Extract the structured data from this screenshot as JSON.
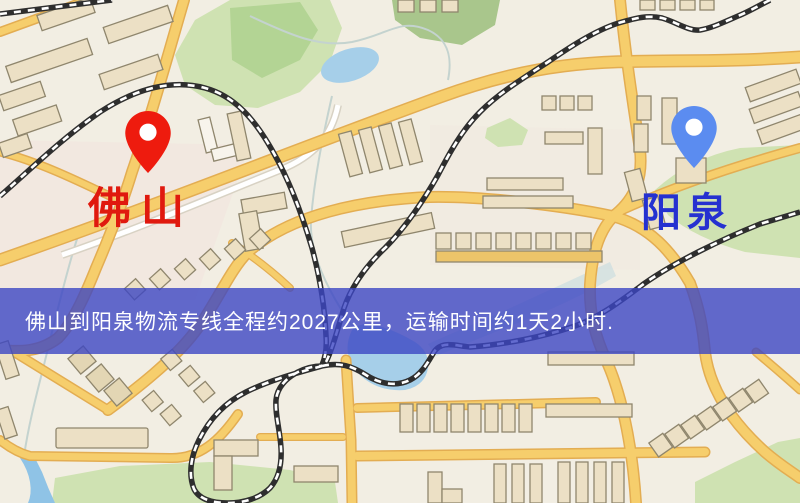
{
  "banner": {
    "text": "佛山到阳泉物流专线全程约2027公里，运输时间约1天2小时.",
    "background_color": "rgba(60,70,195,0.8)",
    "text_color": "#ffffff"
  },
  "route": {
    "origin": "佛山",
    "destination": "阳泉",
    "distance_text": "约2027公里",
    "duration_text": "约1天2小时"
  },
  "markers": {
    "origin": {
      "name": "佛山",
      "pin_color": "#ee1b0e",
      "label_color": "#e0190e"
    },
    "destination": {
      "name": "阳泉",
      "pin_color": "#5b8cf0",
      "label_color": "#2531d0"
    }
  },
  "map": {
    "colors": {
      "background": "#f2eee3",
      "road_fill": "#f6ce6c",
      "road_casing": "#e3ad52",
      "minor_road": "#ffffff",
      "park": "#cfe2b2",
      "forest": "#a9c68c",
      "water": "#a6cfe9",
      "railway": "#2e2e2e",
      "building_fill": "#ece0c5",
      "building_outline": "#8f866d"
    }
  }
}
